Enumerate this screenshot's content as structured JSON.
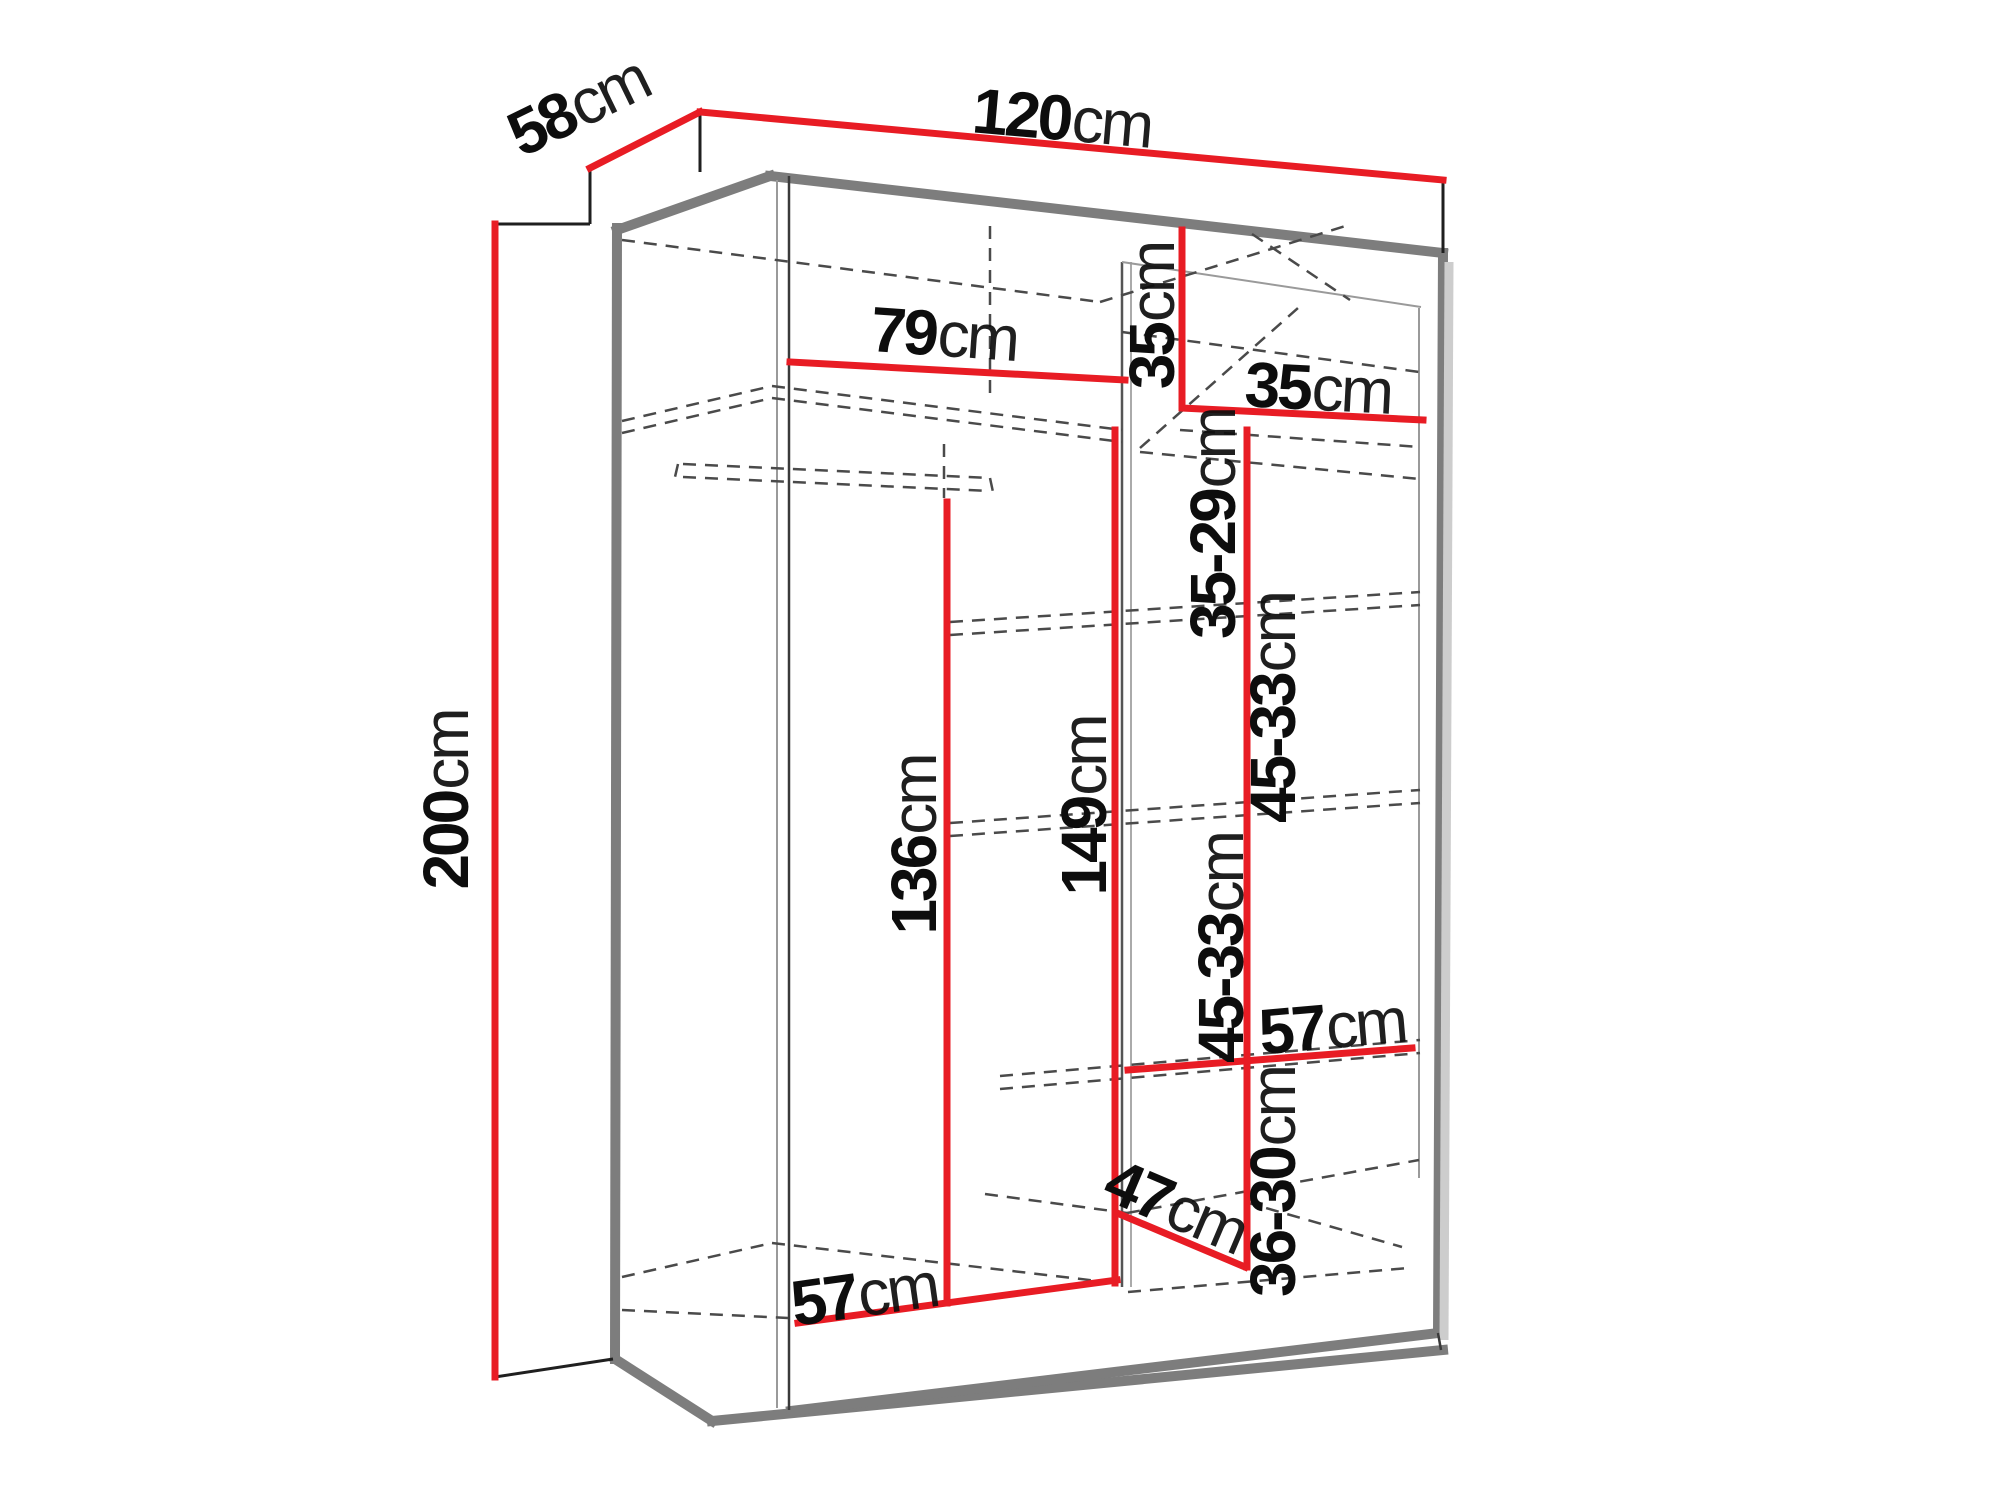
{
  "diagram": {
    "type": "furniture-dimension-diagram",
    "subject": "two-door sliding wardrobe, isometric line drawing",
    "unit": "cm",
    "colors": {
      "dimension_line": "#e81c24",
      "outline_gray": "#7d7d7d",
      "hidden_line": "#4a4a4a",
      "label_text": "#0d0d0d",
      "background": "#ffffff"
    },
    "dimensions": [
      {
        "name": "depth-top",
        "label": "58",
        "unit": "cm"
      },
      {
        "name": "width-top",
        "label": "120",
        "unit": "cm"
      },
      {
        "name": "height-left",
        "label": "200",
        "unit": "cm"
      },
      {
        "name": "interior-width-top",
        "label": "79",
        "unit": "cm"
      },
      {
        "name": "top-cubby-height",
        "label": "35",
        "unit": "cm"
      },
      {
        "name": "top-cubby-width",
        "label": "35",
        "unit": "cm"
      },
      {
        "name": "shelf-gap-1",
        "label": "35-29",
        "unit": "cm"
      },
      {
        "name": "shelf-gap-2",
        "label": "45-33",
        "unit": "cm"
      },
      {
        "name": "hanging-space-height",
        "label": "136",
        "unit": "cm"
      },
      {
        "name": "shelf-column-height",
        "label": "149",
        "unit": "cm"
      },
      {
        "name": "shelf-gap-3",
        "label": "45-33",
        "unit": "cm"
      },
      {
        "name": "shelf-width-right",
        "label": "57",
        "unit": "cm"
      },
      {
        "name": "shelf-gap-4",
        "label": "36-30",
        "unit": "cm"
      },
      {
        "name": "bottom-shelf-depth",
        "label": "47",
        "unit": "cm"
      },
      {
        "name": "floor-width-left",
        "label": "57",
        "unit": "cm"
      }
    ]
  }
}
